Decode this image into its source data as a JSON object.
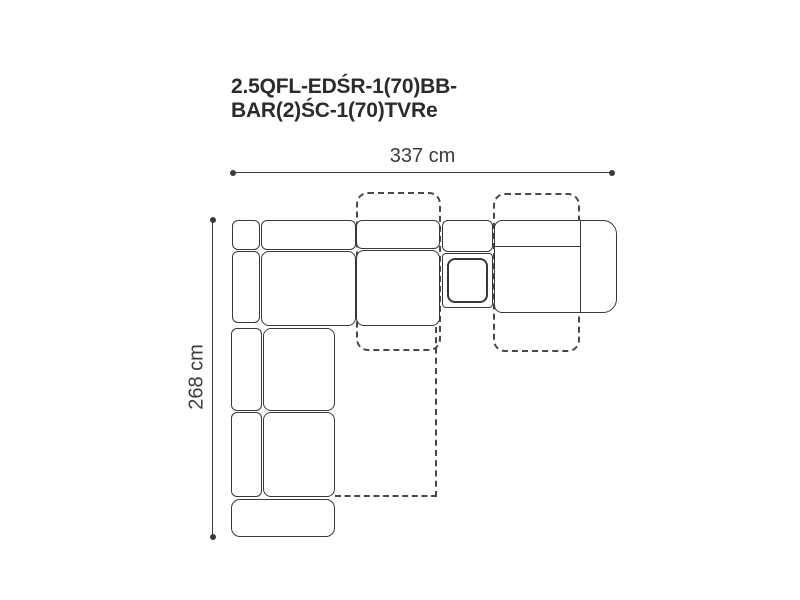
{
  "title": {
    "line1": "2.5QFL-EDŚR-1(70)BB-",
    "line2": "BAR(2)ŚC-1(70)TVRe"
  },
  "dimensions": {
    "width_label": "337 cm",
    "height_label": "268 cm"
  },
  "colors": {
    "line": "#383838",
    "dashed_line": "#474747",
    "title_text": "#2b2b2b",
    "dimension_text": "#3b3b3b",
    "background": "#ffffff"
  },
  "diagram": {
    "type": "sectional-sofa-floor-plan",
    "solid_parts": [
      "corner-back-square",
      "corner-back-top",
      "corner-back-left",
      "corner-seat",
      "middle-backrest",
      "middle-seat",
      "bar-backrest",
      "bar-body",
      "bar-tray",
      "right-module",
      "chaise-back-strip-upper",
      "chaise-seat-upper",
      "chaise-back-strip-lower",
      "chaise-seat-lower",
      "ottoman-end"
    ],
    "dashed_outlines": [
      "middle-recliner-extension",
      "right-recliner-extension",
      "fold-out-bed-extension"
    ]
  }
}
